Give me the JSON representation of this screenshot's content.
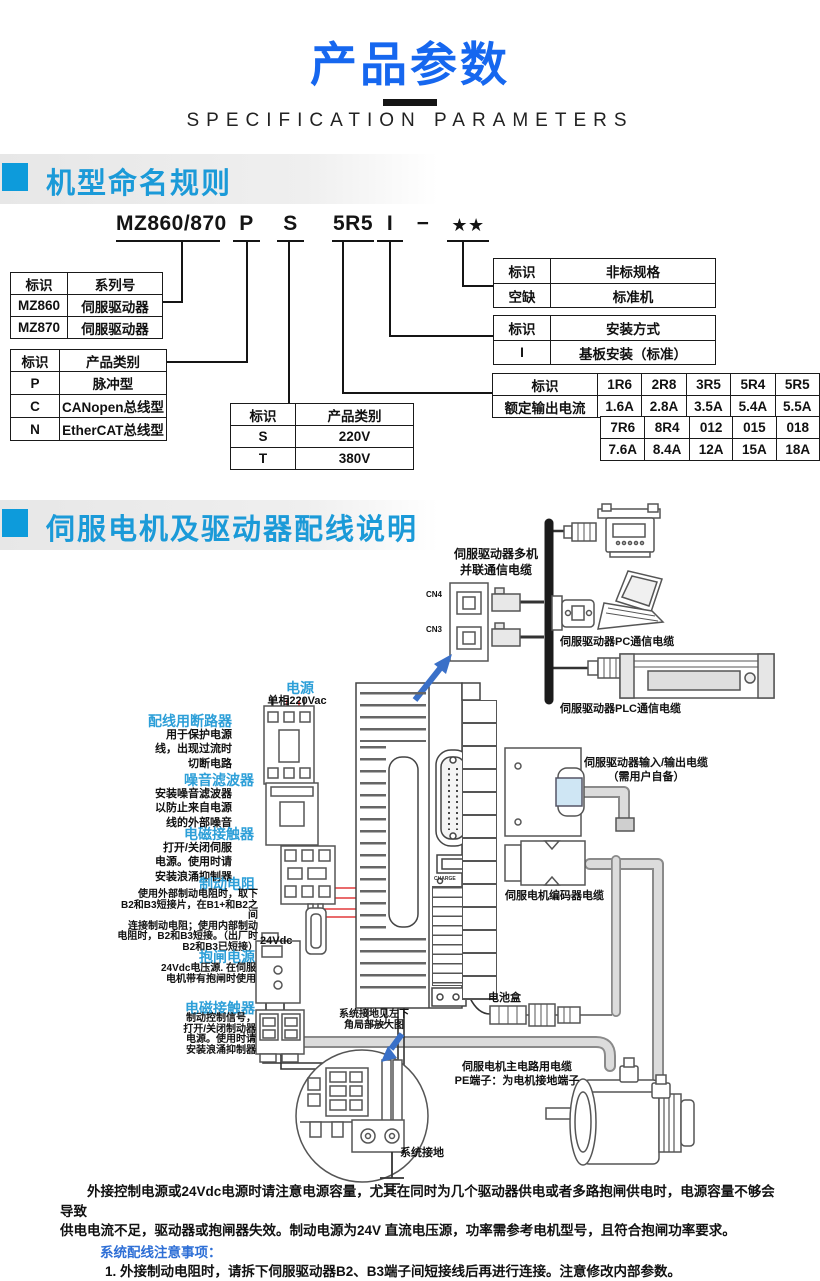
{
  "page": {
    "title": "产品参数",
    "subtitle": "SPECIFICATION PARAMETERS"
  },
  "colors": {
    "title_blue": "#1667ef",
    "section_blue": "#1b9ad8",
    "section_square": "#0d9bdb",
    "label_blue": "#2d9fd8",
    "table_blue": "#2e6fd6",
    "wire_red": "#e23a3c",
    "arrow_blue": "#3a70c8"
  },
  "s1": {
    "heading": "机型命名规则",
    "model": {
      "parts": [
        "MZ860/870",
        "P",
        "S",
        "5R5",
        "I",
        "−",
        "★★"
      ]
    },
    "t_series": {
      "h": [
        "标识",
        "系列号"
      ],
      "rows": [
        [
          "MZ860",
          "伺服驱动器"
        ],
        [
          "MZ870",
          "伺服驱动器"
        ]
      ]
    },
    "t_ptype": {
      "h": [
        "标识",
        "产品类别"
      ],
      "rows": [
        [
          "P",
          "脉冲型"
        ],
        [
          "C",
          "CANopen总线型"
        ],
        [
          "N",
          "EtherCAT总线型"
        ]
      ]
    },
    "t_volt": {
      "h": [
        "标识",
        "产品类别"
      ],
      "rows": [
        [
          "S",
          "220V"
        ],
        [
          "T",
          "380V"
        ]
      ]
    },
    "t_nonstd": {
      "h": [
        "标识",
        "非标规格"
      ],
      "rows": [
        [
          "空缺",
          "标准机"
        ]
      ]
    },
    "t_mount": {
      "h": [
        "标识",
        "安装方式"
      ],
      "rows": [
        [
          "I",
          "基板安装（标准）"
        ]
      ]
    },
    "t_cur": {
      "row1_label": "标识",
      "row1": [
        "1R6",
        "2R8",
        "3R5",
        "5R4",
        "5R5"
      ],
      "row2_label": "额定输出电流",
      "row2": [
        "1.6A",
        "2.8A",
        "3.5A",
        "5.4A",
        "5.5A"
      ],
      "row3": [
        "7R6",
        "8R4",
        "012",
        "015",
        "018"
      ],
      "row4": [
        "7.6A",
        "8.4A",
        "12A",
        "15A",
        "18A"
      ]
    }
  },
  "s2": {
    "heading": "伺服电机及驱动器配线说明",
    "labels": {
      "power_title": "电源",
      "power_sub": "单相220Vac",
      "breaker_title": "配线用断路器",
      "breaker_desc": "用于保护电源\n线，出现过流时\n切断电路",
      "filter_title": "噪音滤波器",
      "filter_desc": "安装噪音滤波器\n以防止来自电源\n线的外部噪音",
      "contactor_title": "电磁接触器",
      "contactor_desc": "打开/关闭伺服\n电源。使用时请\n安装浪涌抑制器",
      "brake_res_title": "制动电阻",
      "brake_res_desc": "使用外部制动电阻时，取下\nB2和B3短接片，在B1+和B2之间\n连接制动电阻；使用内部制动\n电阻时，B2和B3短接。（出厂时\nB2和B3已短接）",
      "v24": "24Vdc",
      "brake_pwr_title": "抱闸电源",
      "brake_pwr_desc": "24Vdc电压源. 在伺服\n电机带有抱闸时使用",
      "contactor2_title": "电磁接触器",
      "contactor2_desc": "制动控制信号，\n打开/关闭制动器\n电源。使用时请\n安装浪涌抑制器",
      "multi_comm": "伺服驱动器多机\n并联通信电缆",
      "cn4": "CN4",
      "cn3": "CN3",
      "pc_cable": "伺服驱动器PC通信电缆",
      "plc_cable": "伺服驱动器PLC通信电缆",
      "io_cable": "伺服驱动器输入/输出电缆\n（需用户自备）",
      "encoder_cable": "伺服电机编码器电缆",
      "battery": "电池盒",
      "ground_note": "系统接地见左下\n角局部放大图",
      "motor_cable": "伺服电机主电路用电缆\nPE端子：为电机接地端子",
      "sys_ground": "系统接地",
      "charge": "CHARGE"
    }
  },
  "notes": {
    "para": "外接控制电源或24Vdc电源时请注意电源容量，尤其在同时为几个驱动器供电或者多路抱闸供电时，电源容量不够会导致\n供电电流不足，驱动器或抱闸器失效。制动电源为24V 直流电压源，功率需参考电机型号，且符合抱闸功率要求。",
    "heading": "系统配线注意事项：",
    "items": [
      "1. 外接制动电阻时，请拆下伺服驱动器B2、B3端子间短接线后再进行连接。注意修改内部参数。",
      "2. CN3以及CN4为两针脚定义完全一致的通讯接口，可以在两者间任意挑选使用。",
      "3. 在单相220V 配线中，主回路端子为 L1、L2，保留端子请勿进行接线。"
    ]
  }
}
